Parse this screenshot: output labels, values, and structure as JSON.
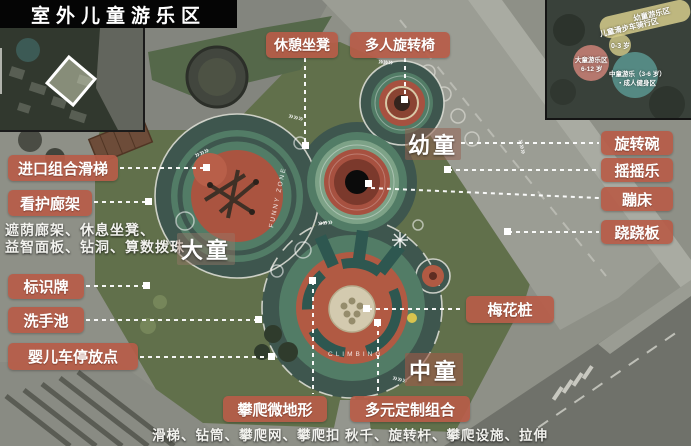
{
  "title": "室外儿童游乐区",
  "callouts": {
    "rest_bench": "休憩坐凳",
    "multi_spinner": "多人旋转椅",
    "import_slide": "进口组合滑梯",
    "care_pergola": "看护廊架",
    "pergola_note_line1": "遮荫廊架、休息坐凳、",
    "pergola_note_line2": "益智面板、钻洞、算数拨珠",
    "signboard": "标识牌",
    "wash_basin": "洗手池",
    "stroller_parking": "婴儿车停放点",
    "spinning_bowl": "旋转碗",
    "rocker": "摇摇乐",
    "trampoline": "蹦床",
    "seesaw": "跷跷板",
    "plum_piles": "梅花桩",
    "climbing_terrain": "攀爬微地形",
    "climbing_terrain_note": "滑梯、钻筒、攀爬网、攀爬扣",
    "custom_combo": "多元定制组合",
    "custom_combo_note": "秋千、旋转杆、攀爬设施、拉伸"
  },
  "zones": {
    "toddler": "幼童",
    "older_child": "大童",
    "middle_child": "中童"
  },
  "inset_zoning": {
    "band_label": "幼童游乐区",
    "band_sublabel": "儿童滑步车骑行区",
    "band_age": "0-3 岁",
    "pink_label": "大童游乐区",
    "pink_age": "6-12 岁",
    "teal_label": "中童游乐（3-6 岁）",
    "teal_sublabel": "・成人健身区"
  },
  "map_text": {
    "funny_zone": "FUNNY ZONE",
    "climbing": "CLIMBING"
  },
  "colors": {
    "callout_bg": "#b75c48",
    "accent_red": "#aa5440",
    "accent_teal": "#2e5750",
    "accent_green": "#527c66",
    "track_dark": "#3e564e"
  }
}
